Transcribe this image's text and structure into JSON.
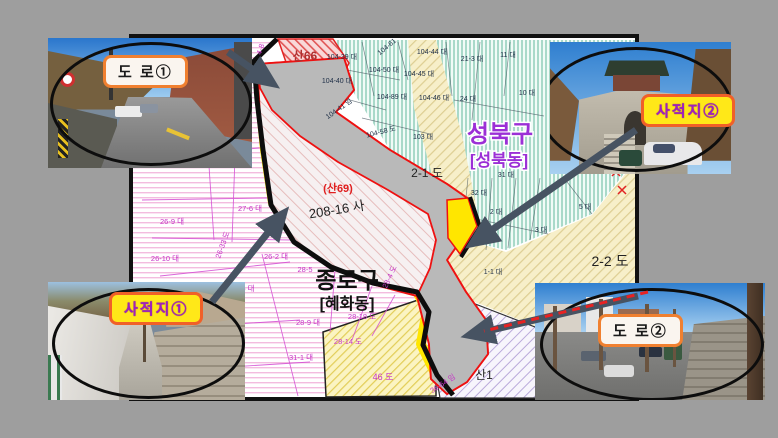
{
  "slide": {
    "background": "#9e9e9e"
  },
  "map": {
    "border_color": "#111111",
    "districts": {
      "seongbuk": {
        "name": "성북구",
        "sub": "[성북동]",
        "color": "#9b2fd6"
      },
      "jongno": {
        "name": "종로구",
        "sub": "[혜화동]",
        "color": "#111111"
      }
    },
    "subject": {
      "san_label": "(산69)",
      "lot_label": "208-16 사",
      "outline_color": "#ee1111",
      "road_fill": "#b9b9b9",
      "buffer_color": "#ffe600"
    },
    "labels": {
      "san66": "산66",
      "san1": "산1",
      "road_2_1": "2-1 도",
      "road_2_2": "2-2 도",
      "road_46": "46 도"
    },
    "parcels_seongbuk": [
      "104-39 대",
      "104-44 대",
      "104-50 대",
      "104-45 대",
      "104-40 대",
      "104-89 대",
      "104-46 대",
      "104-58 도",
      "103 대",
      "104-61",
      "104-41 임",
      "21-3 대",
      "11 대",
      "24 대",
      "10 대",
      "31 대",
      "32 대",
      "2 대",
      "3 대",
      "5 대",
      "1-1 대"
    ],
    "parcels_jongno": [
      "4-8",
      "27-6 대",
      "26-9 대",
      "26-10 대",
      "26-33 도",
      "26-2 대",
      "28-5",
      "5 대",
      "28-9 대",
      "28-18 도",
      "28-4 도",
      "28-14 도",
      "31-1 대",
      "36-64 임"
    ]
  },
  "callouts": {
    "road1": {
      "label": "도 로①"
    },
    "site2": {
      "label": "사적지②"
    },
    "site1": {
      "label": "사적지①"
    },
    "road2": {
      "label": "도 로②"
    }
  }
}
